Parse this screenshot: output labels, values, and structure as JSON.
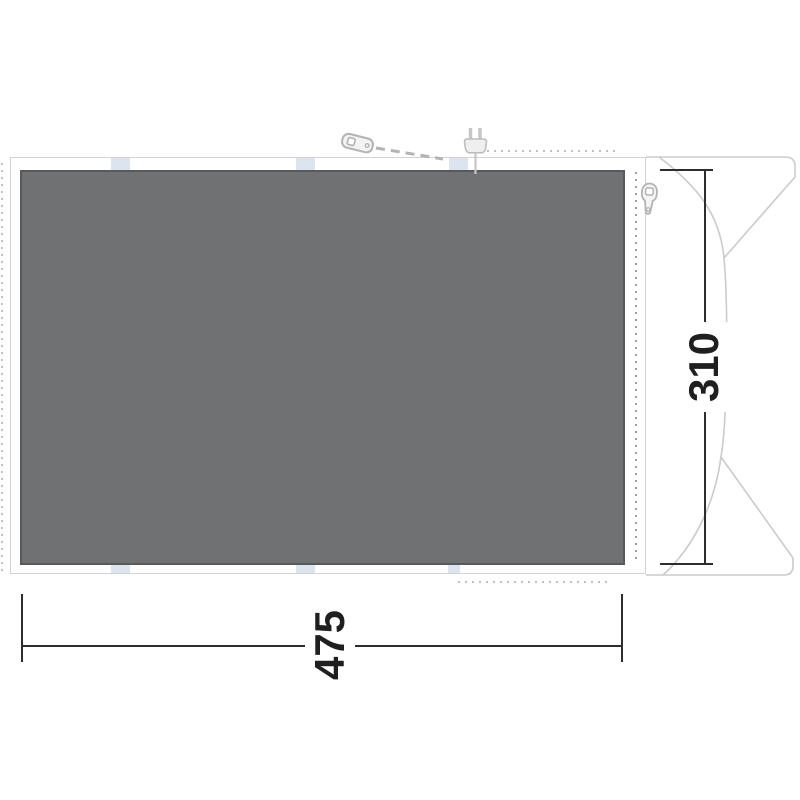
{
  "diagram": {
    "title": "tent-footprint-plan",
    "footprint": {
      "width_label": "475",
      "depth_label": "310"
    },
    "icons": [
      {
        "name": "guy-peg-icon"
      },
      {
        "name": "power-plug-icon"
      },
      {
        "name": "zipper-pull-icon"
      }
    ],
    "colors": {
      "background": "#ffffff",
      "footprint_fill": "#6f7173",
      "footprint_border": "#57595b",
      "frame_line": "#d2d2d2",
      "tent_outline": "#cbcbcb",
      "stitch_dots": "#c2c2c2",
      "zipper_teeth": "#9e9e9e",
      "attachment_tab": "#dce5ef",
      "dimension": "#2d2d2d"
    }
  }
}
